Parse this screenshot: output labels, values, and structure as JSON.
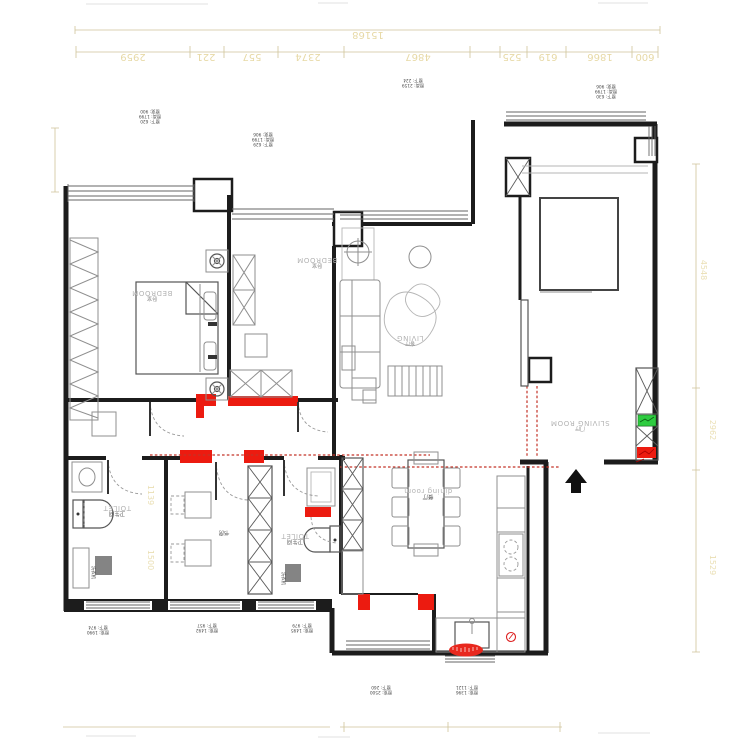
{
  "labels": {
    "bedroom1_en": "BEDROOM",
    "bedroom1_zh": "卧室",
    "bedroom2_en": "BEDROOM",
    "bedroom2_zh": "卧室",
    "living_en": "LIVING",
    "living_zh": "客厅",
    "entry_en": "SLIVING ROOM",
    "entry_zh": "门厅",
    "toilet1_en": "TOILET",
    "toilet1_zh": "卫生间",
    "toilet2_en": "TOILET",
    "toilet2_zh": "卫生间",
    "dining_en": "dining room",
    "dining_zh": "餐厅",
    "study_zh": "书房",
    "washer1": "洗衣机",
    "washer2": "洗衣机"
  },
  "dims": {
    "top_total": "15168",
    "top_row": [
      "2959",
      "221",
      "557",
      "2374",
      "4867",
      "525",
      "619",
      "1866",
      "600"
    ],
    "right_col": [
      "4548",
      "2962",
      "1529"
    ],
    "inner_left": [
      "1139",
      "1500"
    ]
  },
  "window_notes": {
    "a": [
      "窗宽: 900",
      "窗高: 1799",
      "窗下: 620"
    ],
    "b": [
      "窗宽: 906",
      "窗高: 1799",
      "窗下: 629"
    ],
    "c": [
      "窗下: 224",
      "窗高: 2159"
    ],
    "d": [
      "窗宽: 906",
      "窗高: 1799",
      "窗下: 630"
    ],
    "f": [
      "窗下: 974",
      "窗宽: 1990"
    ],
    "g": [
      "窗下: 957",
      "窗宽: 1492"
    ],
    "h": [
      "窗下: 979",
      "窗宽: 1495"
    ],
    "i": [
      "窗下: 260",
      "窗宽: 2500"
    ],
    "j": [
      "窗下: 1121",
      "窗宽: 1396"
    ]
  },
  "colors": {
    "accent_red": "#ec1b10",
    "accent_green": "#2ecc40",
    "dimension_text": "#e7d9a6"
  }
}
